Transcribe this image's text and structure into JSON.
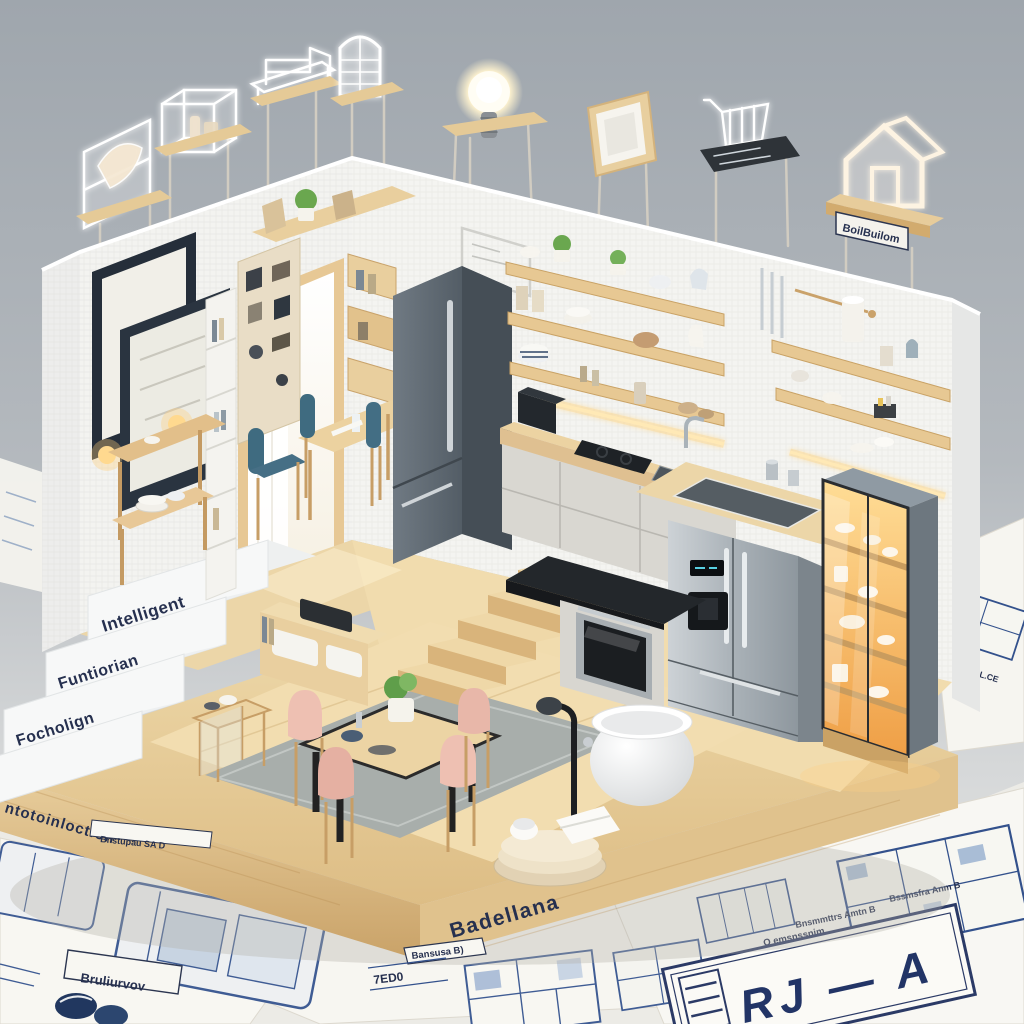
{
  "palette": {
    "background_top": "#9fa6ad",
    "background_bottom": "#e9e9e6",
    "paper": "#f8f7f2",
    "blueprint_ink": "#3f5c94",
    "navy_text": "#26304f",
    "wood_light": "#ecd6ab",
    "wood_dark": "#c49a62",
    "wall_white": "#f3f3f0",
    "fridge_gray": "#5f6a72",
    "stainless": "#c9ced2",
    "glow_amber": "#f5a94f",
    "chair_teal": "#3f6b80",
    "chair_pink": "#eec0b2"
  },
  "hologram_icons": [
    {
      "name": "wireframe-sideboard-icon"
    },
    {
      "name": "wireframe-display-cube-icon"
    },
    {
      "name": "wireframe-table-icon"
    },
    {
      "name": "wireframe-arch-cabinet-icon"
    },
    {
      "name": "light-bulb-icon"
    },
    {
      "name": "picture-frame-icon"
    },
    {
      "name": "shopping-cart-icon"
    },
    {
      "name": "house-outline-icon"
    }
  ],
  "labels": {
    "stairs": [
      "Intelligent",
      "Funtiorian",
      "Focholign"
    ],
    "base_left_edge": "ntotoinloction",
    "base_front_edge": "Badellana",
    "house_sign": "BoilBuilom",
    "paper_tags": {
      "tag_left": "Bnstupau SA D",
      "box_left": "Bruliurvov",
      "tag_center": "Bansusa B)",
      "code_center": "7ED0",
      "side_sheet": "OSTTTIL.CE"
    },
    "titleblock": {
      "main": "RJ — A",
      "note_top": "Bssmsfra Anm B",
      "note_code": "6.03 D",
      "note_mid": "Bnsmmttrs Amtn B",
      "note_low": "O emsnssnim",
      "note_bottom": "Assmsnstrs ss(t)"
    }
  }
}
